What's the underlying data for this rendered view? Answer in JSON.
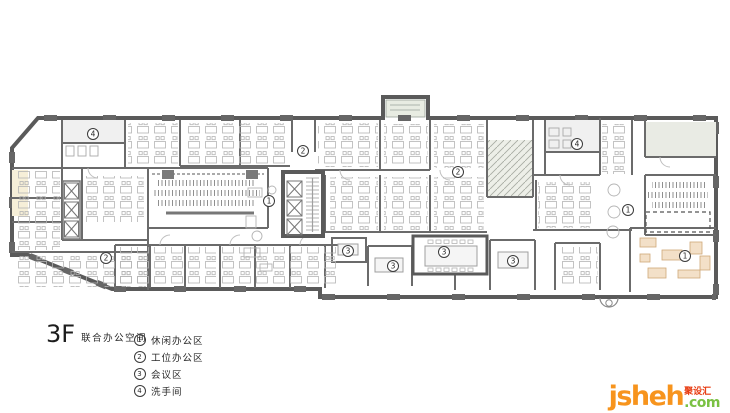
{
  "plan": {
    "floor": "3F",
    "floor_name": "联合办公空间",
    "legend": [
      {
        "num": "1",
        "label": "休闲办公区"
      },
      {
        "num": "2",
        "label": "工位办公区"
      },
      {
        "num": "3",
        "label": "会议区"
      },
      {
        "num": "4",
        "label": "洗手间"
      }
    ],
    "area_labels": [
      {
        "num": "4",
        "x": 93,
        "y": 134
      },
      {
        "num": "2",
        "x": 303,
        "y": 151
      },
      {
        "num": "2",
        "x": 458,
        "y": 172
      },
      {
        "num": "4",
        "x": 577,
        "y": 144
      },
      {
        "num": "1",
        "x": 269,
        "y": 201
      },
      {
        "num": "2",
        "x": 106,
        "y": 258
      },
      {
        "num": "3",
        "x": 348,
        "y": 251
      },
      {
        "num": "3",
        "x": 393,
        "y": 266
      },
      {
        "num": "3",
        "x": 444,
        "y": 252
      },
      {
        "num": "3",
        "x": 513,
        "y": 261
      },
      {
        "num": "1",
        "x": 628,
        "y": 210
      },
      {
        "num": "1",
        "x": 685,
        "y": 256
      }
    ],
    "colors": {
      "wall": "#5a5a5a",
      "partition": "#6b6b6b",
      "furniture": "#b4b4b4",
      "hatch_room": "#edefe8",
      "green_tint": "#e9ebe4",
      "yellow_tint": "#f6efd8",
      "leisure_accent": "#f3e0c8"
    }
  },
  "logo": {
    "brand": "jsheh",
    "tld": ".com",
    "badge": "聚设汇",
    "brand_color": "#f7941d",
    "tld_color": "#7ac143",
    "badge_color": "#e8380d"
  }
}
